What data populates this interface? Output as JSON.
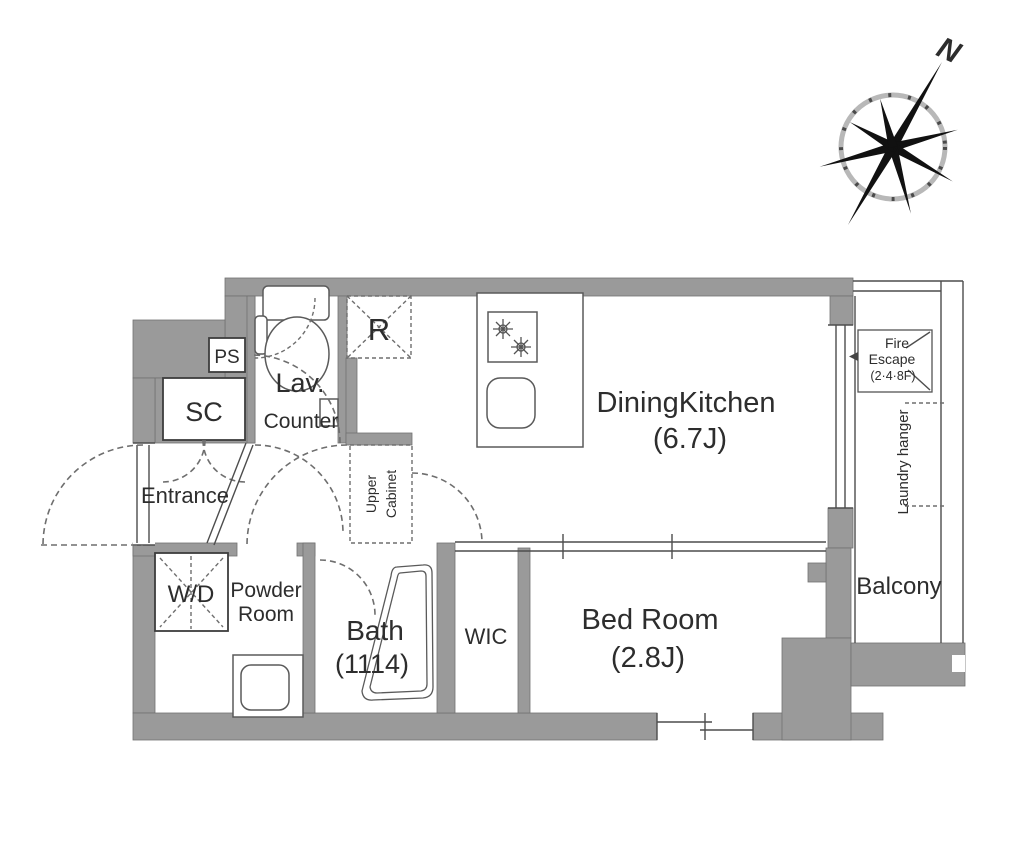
{
  "plan": {
    "compass": {
      "north": "N"
    },
    "labels": {
      "ps": "PS",
      "sc": "SC",
      "lav": "Lav.",
      "lav_counter": "Counter",
      "refrigerator": "R",
      "entrance": "Entrance",
      "upper_cabinet_line1": "Upper",
      "upper_cabinet_line2": "Cabinet",
      "dining_kitchen": "DiningKitchen",
      "dining_kitchen_size": "(6.7J)",
      "fire_escape_line1": "Fire",
      "fire_escape_line2": "Escape",
      "fire_escape_line3": "(2·4·8F)",
      "laundry_hanger": "Laundry hanger",
      "balcony": "Balcony",
      "washer_dryer": "W/D",
      "powder_room_line1": "Powder",
      "powder_room_line2": "Room",
      "bath": "Bath",
      "bath_size": "(1114)",
      "wic": "WIC",
      "bedroom": "Bed Room",
      "bedroom_size": "(2.8J)"
    },
    "colors": {
      "wall": "#9a9a9a",
      "line": "#4d4d4d",
      "text": "#2d2d2d"
    }
  }
}
